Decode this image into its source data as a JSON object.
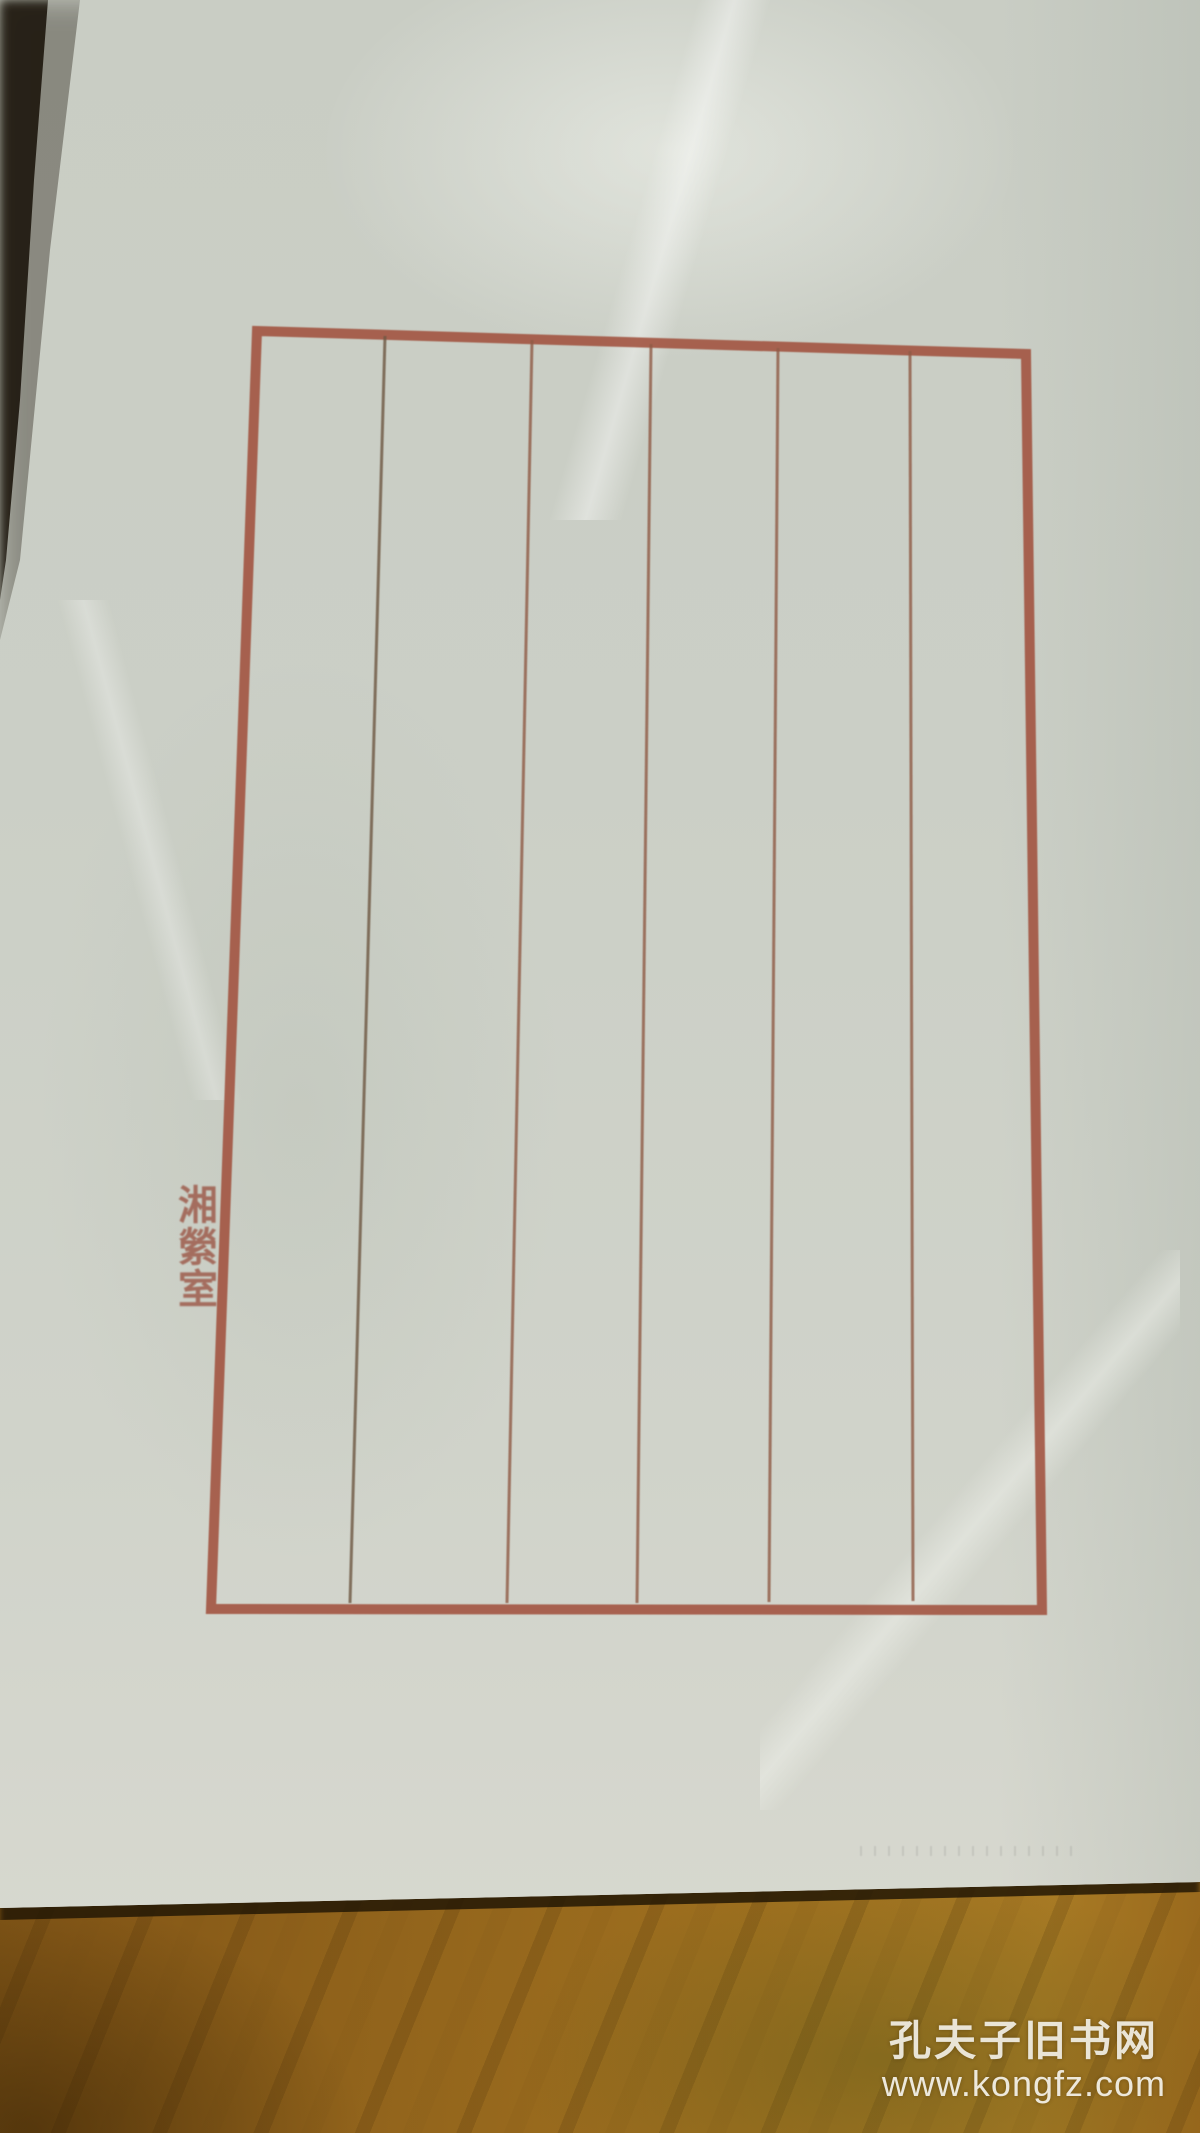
{
  "scene": {
    "description": "Blank sheet of Chinese red-ruled letterpress stationery photographed on a wooden table"
  },
  "paper": {
    "seal_text": "湘縈室",
    "columns": 6,
    "column_rule_count": 5
  },
  "watermark": {
    "site_name": "孔夫子旧书网",
    "site_url": "www.kongfz.com"
  },
  "colors": {
    "frame": "#a0513d",
    "column_line": "#8f5a45",
    "column_line_first": "#6d5742",
    "seal": "#9c5848",
    "paper": "#cccfc6",
    "wood": "#8a5c1d",
    "watermark_text": "#f2efe6",
    "dark_edge": "#221c12"
  }
}
